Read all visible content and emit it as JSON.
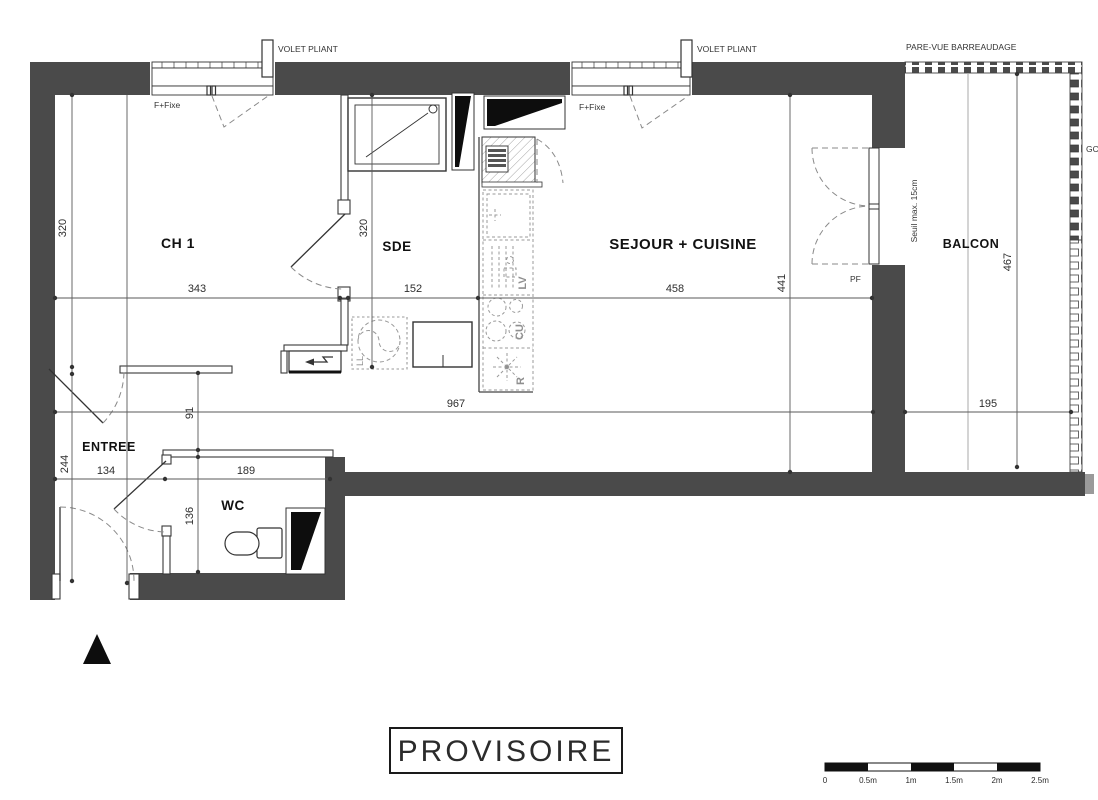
{
  "plan": {
    "stamp": "PROVISOIRE",
    "rooms": {
      "ch1": "CH 1",
      "sde": "SDE",
      "sejour": "SEJOUR + CUISINE",
      "balcon": "BALCON",
      "entree": "ENTREE",
      "wc": "WC"
    },
    "annotations": {
      "volet_pliant_left": "VOLET PLIANT",
      "volet_pliant_right": "VOLET PLIANT",
      "pare_vue": "PARE-VUE BARREAUDAGE",
      "f_fixe_left": "F+Fixe",
      "f_fixe_right": "F+Fixe",
      "seuil": "Seuil max. 15cm",
      "pf": "PF",
      "gc": "GC"
    },
    "appliances": {
      "lv": "LV",
      "cu": "CU",
      "fridge": "R",
      "ll": "LL"
    },
    "dimensions": {
      "ch1_width": "343",
      "ch1_height": "320",
      "sde_width": "152",
      "sde_height": "320",
      "sejour_width": "458",
      "sejour_height": "441",
      "balcon_width": "195",
      "balcon_height": "467",
      "interior_length": "967",
      "hall_width": "91",
      "entree_width": "134",
      "entree_depth": "244",
      "wc_width": "189",
      "wc_depth": "136"
    },
    "scale_bar": {
      "labels": [
        "0",
        "0.5m",
        "1m",
        "1.5m",
        "2m",
        "2.5m"
      ]
    },
    "colors": {
      "wall": "#4a4a4a",
      "line": "#333333",
      "dim": "#3a3a3a",
      "light": "#8f8f8f"
    }
  }
}
